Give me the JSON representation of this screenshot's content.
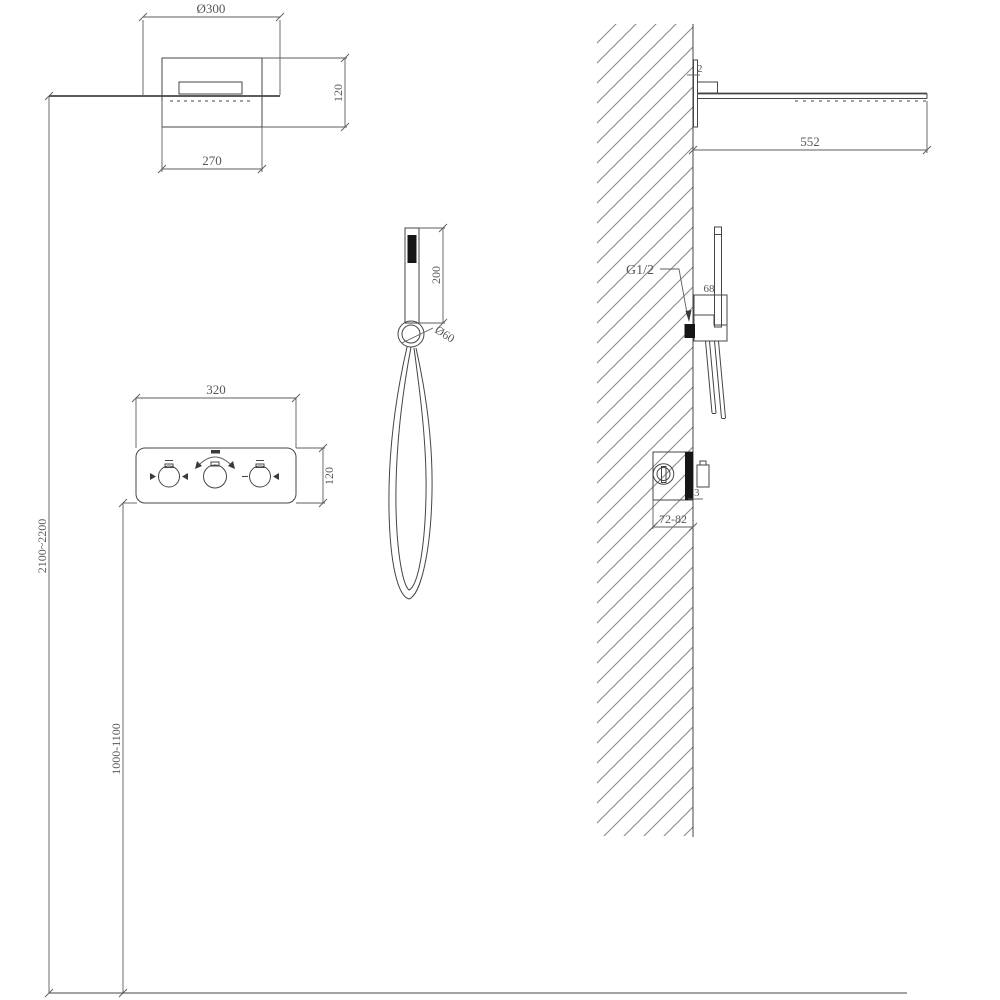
{
  "drawing": {
    "type": "shower-system-installation-technical-drawing",
    "views": [
      "overhead-shower-front",
      "mixer-panel-front",
      "hand-shower-front",
      "wall-section-side"
    ],
    "colors": {
      "background": "#ffffff",
      "line": "#454545",
      "dimension_line": "#5e5e5e",
      "hatch": "#868686",
      "text": "#585858",
      "solid_fill": "#151515"
    },
    "icons": {
      "left_knob_marks": "diverter-triangle-icons",
      "middle_knob_mark": "temperature-rotation-arc-icon",
      "right_knob_marks": "flow-minus-plus-icons"
    }
  },
  "labels": {
    "overhead_diameter": "Ø300",
    "overhead_height": "120",
    "overhead_width": "270",
    "panel_width": "320",
    "panel_height": "120",
    "handshower_length": "200",
    "holder_diameter": "Ø60",
    "overhead_mounting_height": "2100~2200",
    "panel_mounting_height": "1000-1100",
    "arm_projection": "552",
    "wall_plate_thickness": "2",
    "thread_size": "G1/2",
    "holder_depth": "68",
    "trim_gap": "3",
    "embed_depth_range": "72-82"
  }
}
